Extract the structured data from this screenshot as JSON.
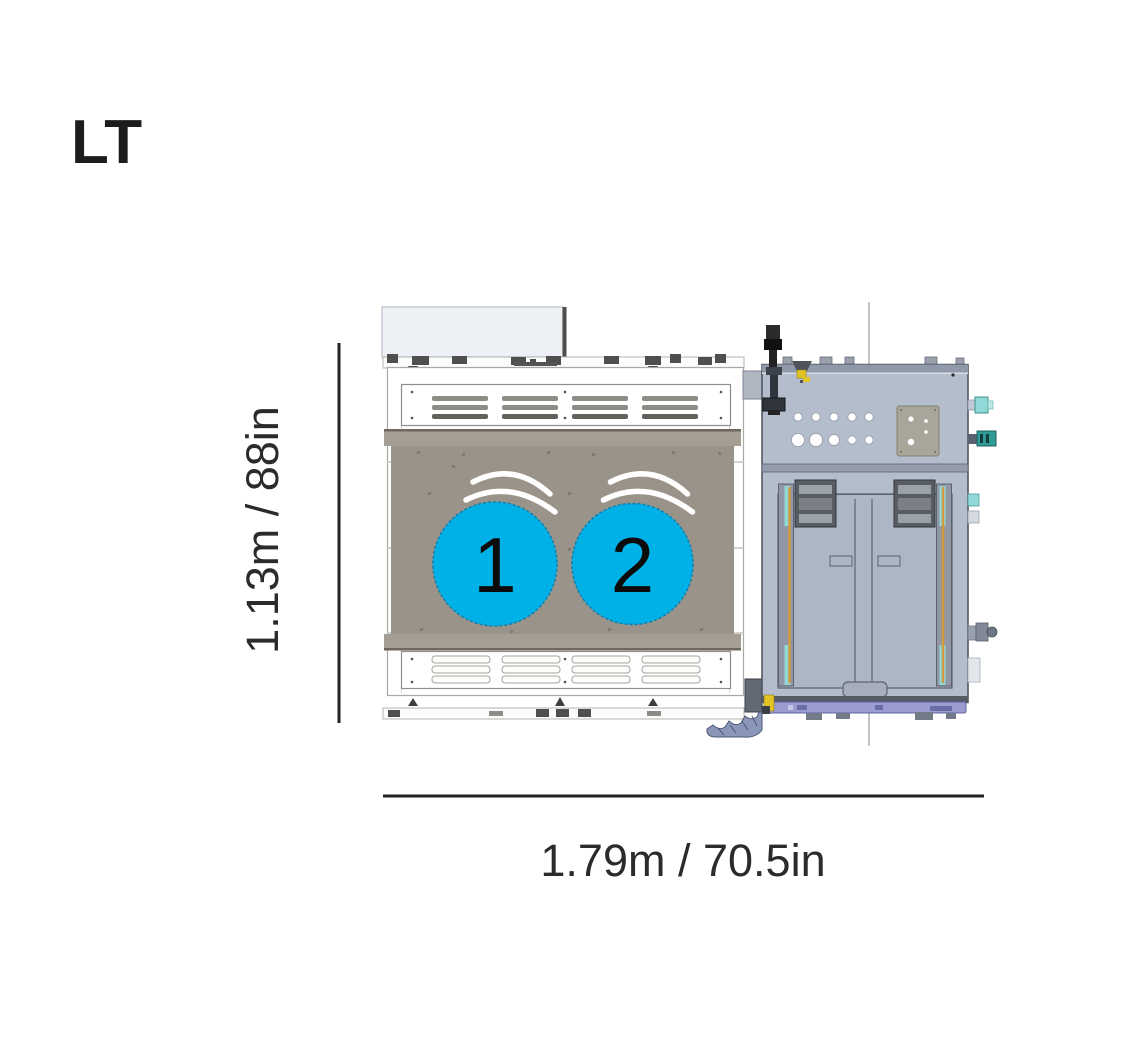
{
  "title": "LT",
  "dimensions": {
    "height_label": "1.13m / 88in",
    "width_label": "1.79m / 70.5in"
  },
  "fans": {
    "fan1_label": "1",
    "fan2_label": "2"
  },
  "colors": {
    "fan_blue": "#00b1e8",
    "panel_taupe": "#9a9389",
    "machine_body": "#b4bdcc",
    "rail_orange": "#d29a3f",
    "rail_cyan": "#8fd9d9",
    "accent_yellow": "#e3c322",
    "strip_purple": "#9b9dd0",
    "teal_connector": "#2f9a96",
    "dimension_line": "#222222",
    "label_text": "#2b2b2b"
  }
}
